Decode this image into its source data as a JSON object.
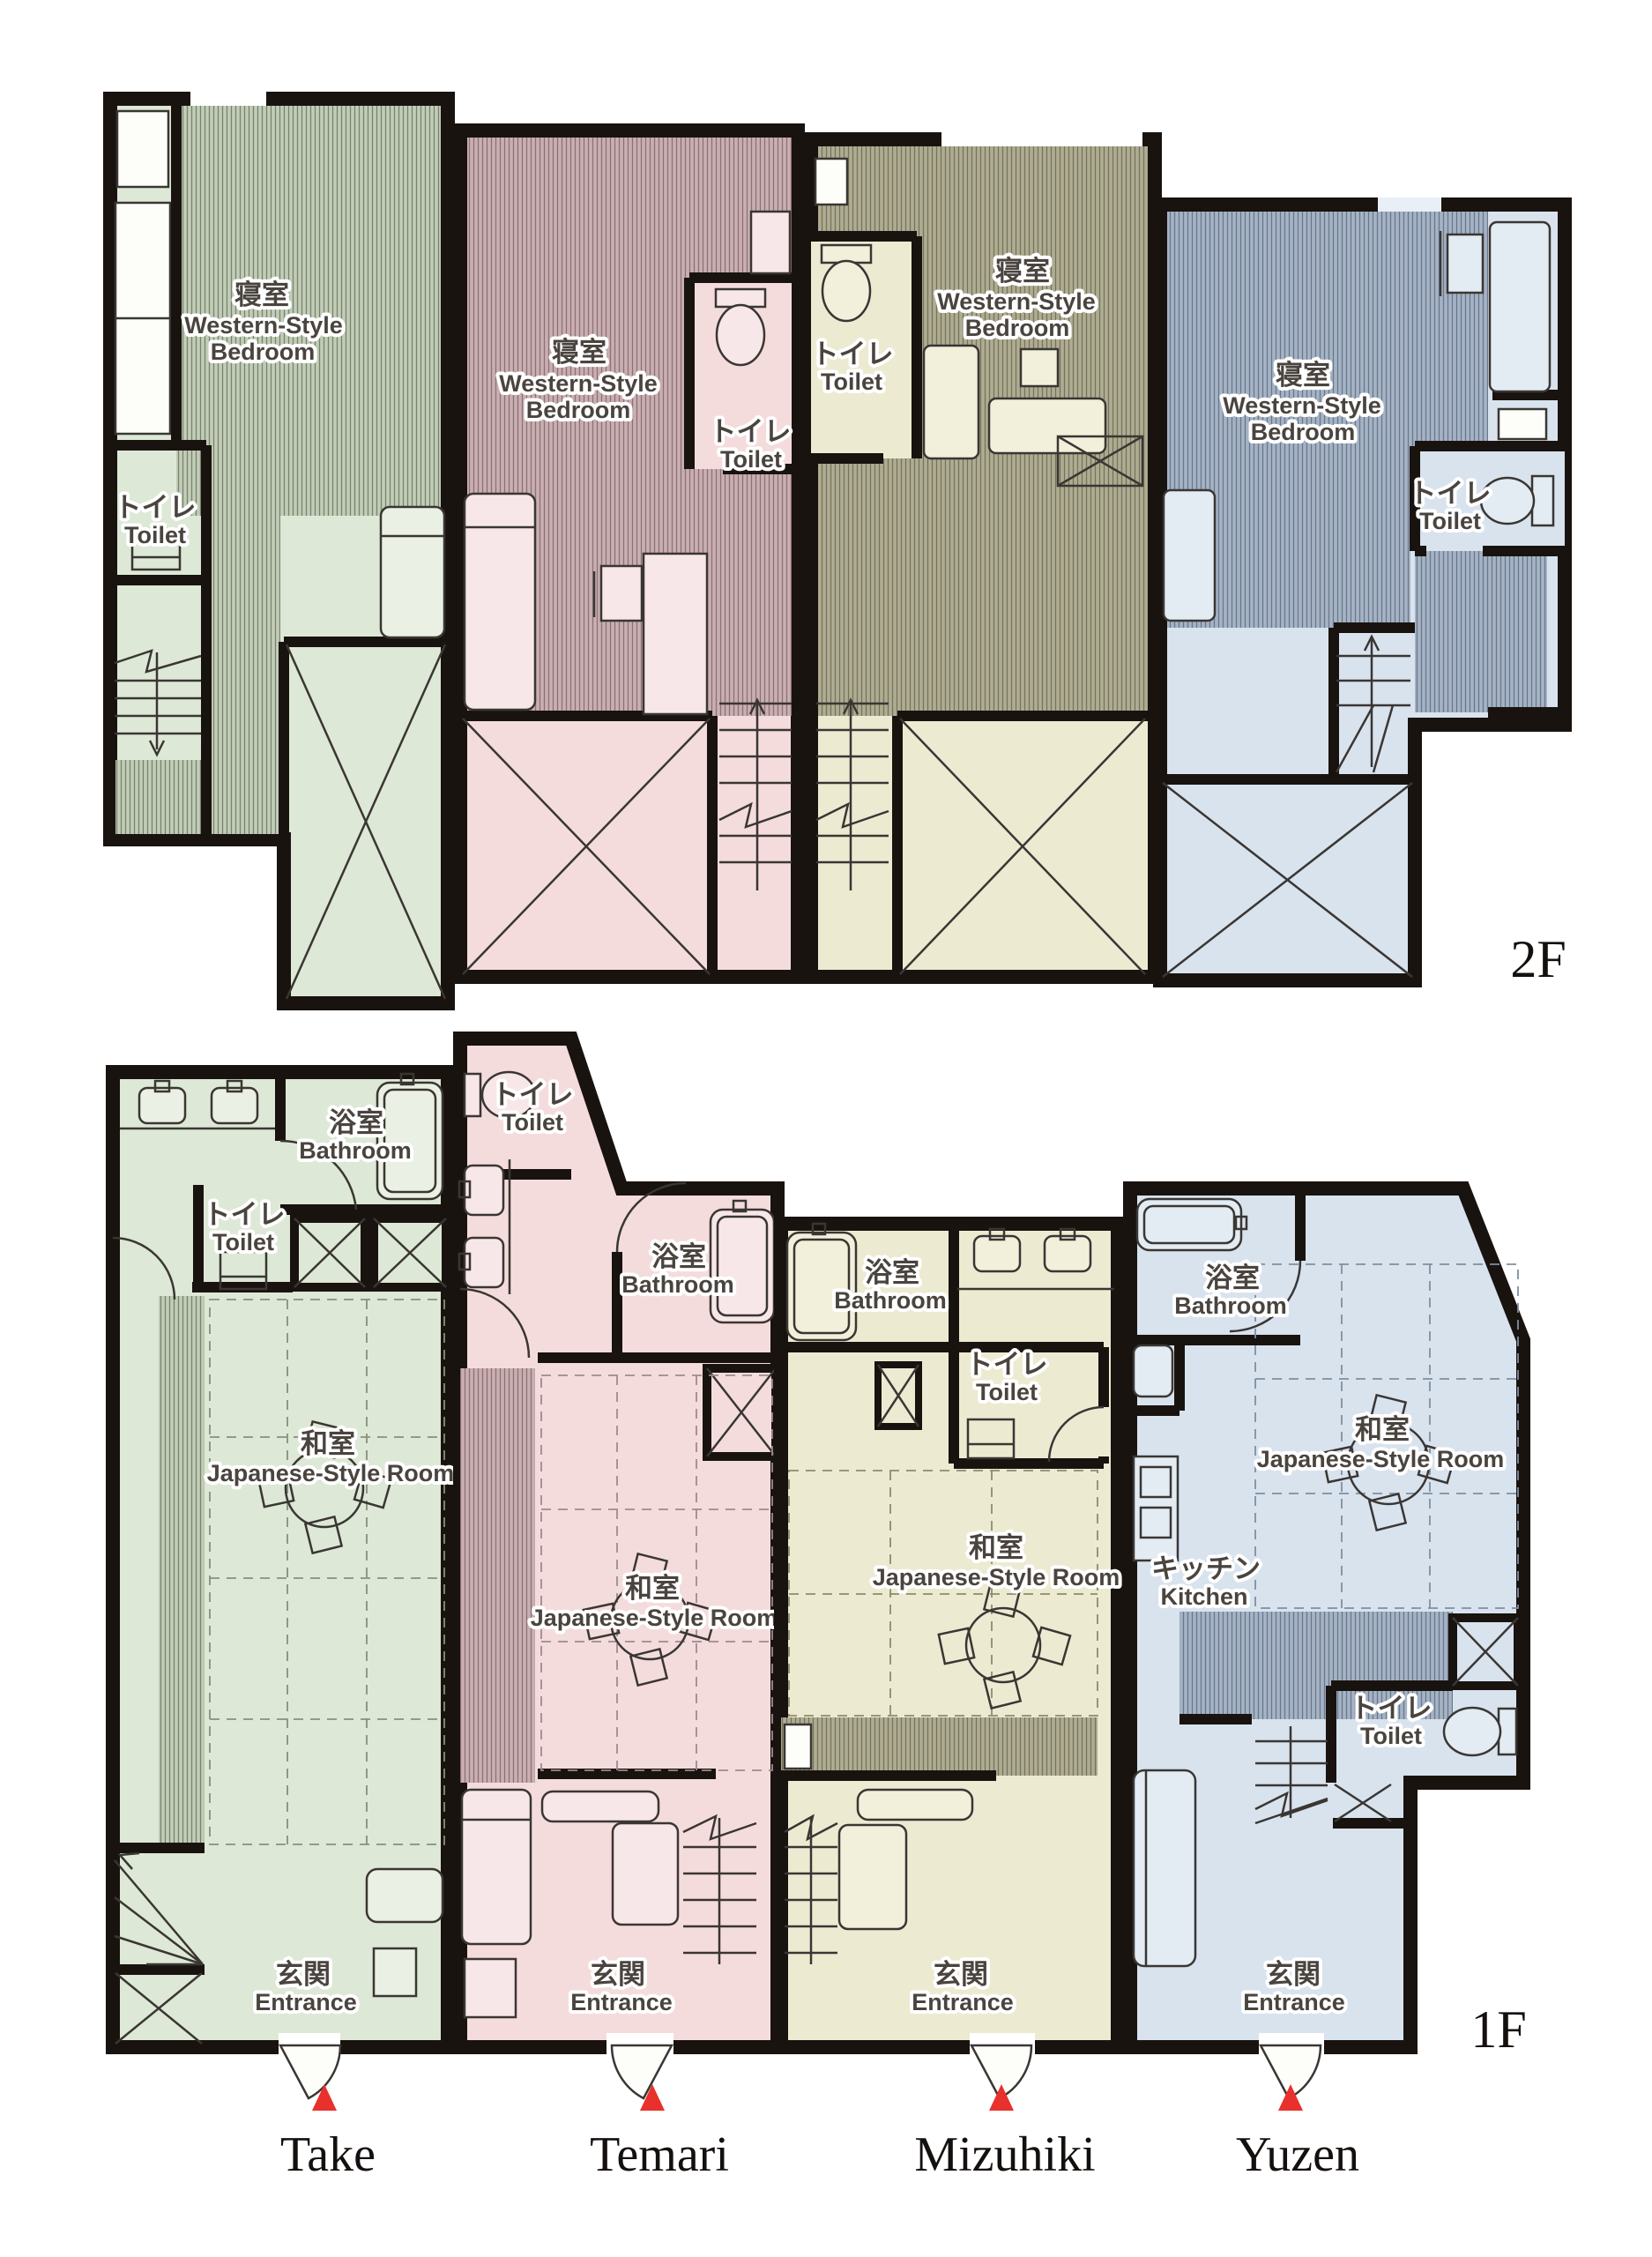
{
  "document": {
    "type": "apartment floor plan",
    "floors_shown": 2,
    "units_shown": 4
  },
  "floor_labels": {
    "second": "2F",
    "first": "1F"
  },
  "room_labels": {
    "bedroom_jp": "寝室",
    "bedroom_en_1": "Western-Style",
    "bedroom_en_2": "Bedroom",
    "toilet_jp": "トイレ",
    "toilet_en": "Toilet",
    "bathroom_jp": "浴室",
    "bathroom_en": "Bathroom",
    "japanese_room_jp": "和室",
    "japanese_room_en": "Japanese-Style Room",
    "kitchen_jp": "キッチン",
    "kitchen_en": "Kitchen",
    "entrance_jp": "玄関",
    "entrance_en": "Entrance"
  },
  "units": [
    {
      "id": "take",
      "name": "Take",
      "color": "#dde8d6"
    },
    {
      "id": "temari",
      "name": "Temari",
      "color": "#f4dcdd"
    },
    {
      "id": "mizuhiki",
      "name": "Mizuhiki",
      "color": "#edead2"
    },
    {
      "id": "yuzen",
      "name": "Yuzen",
      "color": "#d8e3ee"
    }
  ],
  "marker_color": "#e8312d"
}
